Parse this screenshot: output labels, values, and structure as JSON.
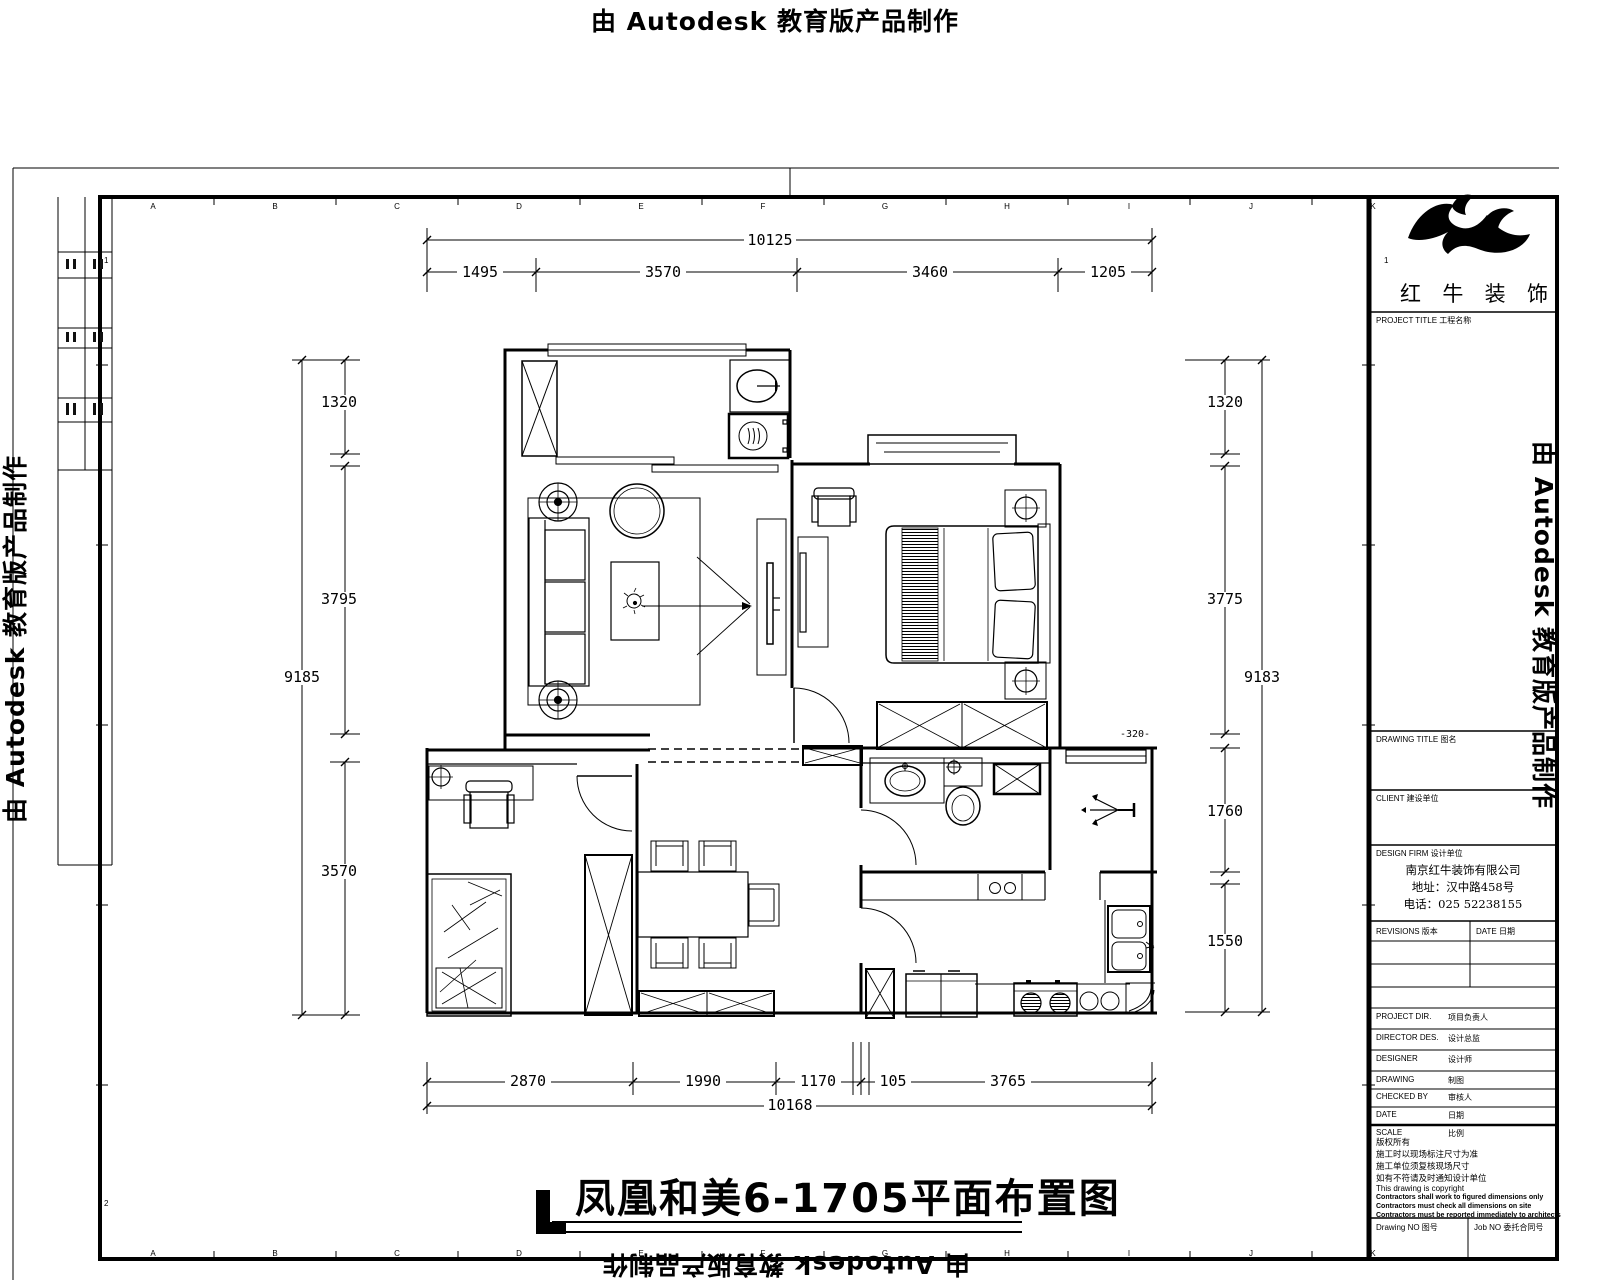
{
  "watermarks": {
    "top": "由 Autodesk 教育版产品制作",
    "left": "由 Autodesk 教育版产品制作",
    "right": "由 Autodesk 教育版产品制作",
    "bottom": "由 Autodesk 教育版产品制作"
  },
  "plan_title": "凤凰和美6-1705平面布置图",
  "dims": {
    "top_overall": "10125",
    "top_segments": [
      "1495",
      "3570",
      "3460",
      "1205"
    ],
    "bottom_overall": "10168",
    "bottom_segments": [
      "2870",
      "1990",
      "1170",
      "105",
      "3765"
    ],
    "left_overall": "9185",
    "left_segments": [
      "1320",
      "3795",
      "3570"
    ],
    "right_overall": "9183",
    "right_segments": [
      "1320",
      "3775",
      "1760",
      "1550"
    ],
    "level_mark": "-320-"
  },
  "grid_letters": [
    "A",
    "B",
    "C",
    "D",
    "E",
    "F",
    "G",
    "H",
    "I",
    "J",
    "K"
  ],
  "grid_rows": [
    "1",
    "2"
  ],
  "title_block": {
    "company": "红牛装饰",
    "company_chars": [
      "红",
      "牛",
      "装",
      "饰"
    ],
    "project_title_label": "PROJECT TITLE  工程名称",
    "drawing_title_label": "DRAWING TITLE  图名",
    "client_label": "CLIENT  建设单位",
    "design_firm_label": "DESIGN FIRM  设计单位",
    "firm_name": "南京红牛装饰有限公司",
    "firm_address": "地址：汉中路458号",
    "firm_phone": "电话：025 52238155",
    "revisions_label": "REVISIONS  版本",
    "date_col_label": "DATE  日期",
    "rows": [
      {
        "en": "PROJECT DIR.",
        "cn": "项目负责人"
      },
      {
        "en": "DIRECTOR DES.",
        "cn": "设计总监"
      },
      {
        "en": "DESIGNER",
        "cn": "设计师"
      },
      {
        "en": "DRAWING",
        "cn": "制图"
      },
      {
        "en": "CHECKED BY",
        "cn": "审核人"
      },
      {
        "en": "DATE",
        "cn": "日期"
      },
      {
        "en": "SCALE",
        "cn": "比例"
      }
    ],
    "notes_cn": [
      "版权所有",
      "施工时以现场标注尺寸为准",
      "施工单位须复核现场尺寸",
      "如有不符请及时通知设计单位"
    ],
    "notes_en_thin": "This drawing is copyright",
    "notes_en_bold": [
      "Contractors shall work to figured dimensions only",
      "Contractors must check all dimensions on site",
      "Contractors must be reported immediately to architects"
    ],
    "drawing_no_label": "Drawing NO  图号",
    "job_no_label": "Job NO  委托合同号"
  }
}
